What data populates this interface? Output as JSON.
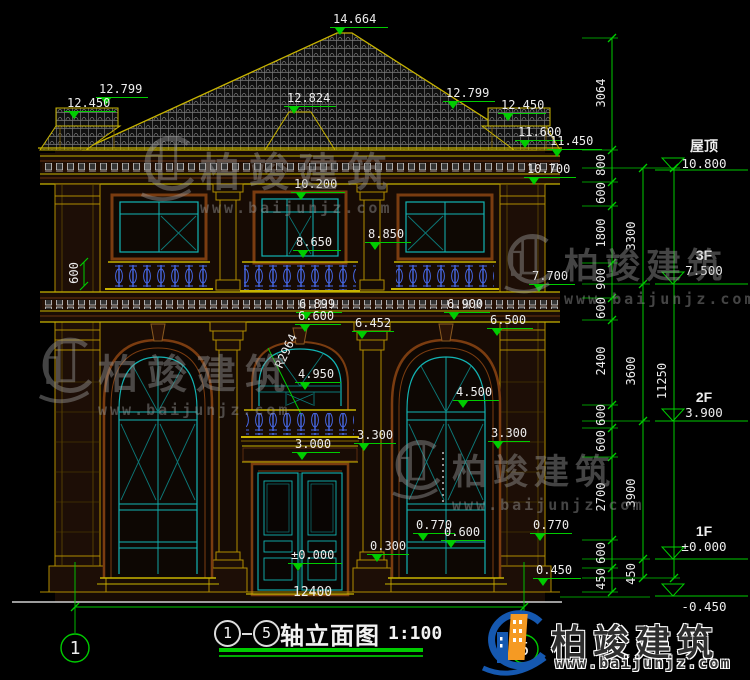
{
  "drawing": {
    "title": {
      "axis_start": "1",
      "axis_end": "5",
      "name": "轴立面图",
      "scale": "1:100"
    },
    "axis_bubbles": {
      "left": "1",
      "right": "5"
    },
    "markers": [
      "14.664",
      "12.799",
      "12.824",
      "12.450",
      "12.799",
      "12.450",
      "11.600",
      "11.450",
      "10.700",
      "10.200",
      "8.850",
      "8.650",
      "7.700",
      "6.899",
      "6.600",
      "6.900",
      "6.452",
      "6.500",
      "R2964",
      "4.950",
      "4.500",
      "3.000",
      "3.300",
      "3.300",
      "0.770",
      "0.600",
      "0.770",
      "0.300",
      "±0.000",
      "0.450"
    ],
    "floors": [
      {
        "name": "屋顶",
        "elev": "10.800"
      },
      {
        "name": "3F",
        "elev": "7.500"
      },
      {
        "name": "2F",
        "elev": "3.900"
      },
      {
        "name": "1F",
        "elev": "±0.000"
      },
      {
        "name": "",
        "elev": "-0.450"
      }
    ],
    "dims": {
      "chain_inner": [
        "3064",
        "800",
        "600",
        "1800",
        "900",
        "600",
        "2400",
        "600",
        "600",
        "2700",
        "600",
        "450"
      ],
      "chain_mid": [
        "3300",
        "3600",
        "3900",
        "450"
      ],
      "chain_outer": [
        "11250"
      ],
      "bottom_width": "12400",
      "left_detail": "600"
    }
  },
  "watermark": {
    "brand": "柏竣建筑",
    "url": "www.baijunjz.com"
  },
  "logo": {
    "brand": "柏竣建筑",
    "url": "www.baijunjz.com"
  },
  "colors": {
    "dim_green": "#00cc00",
    "cad_yellow": "#c8b400",
    "frame_brown": "#7a3c10",
    "glass_cyan": "#12b4b4",
    "baluster_blue": "#4668e8",
    "logo_blue": "#1558b0",
    "logo_orange": "#f59a23"
  }
}
